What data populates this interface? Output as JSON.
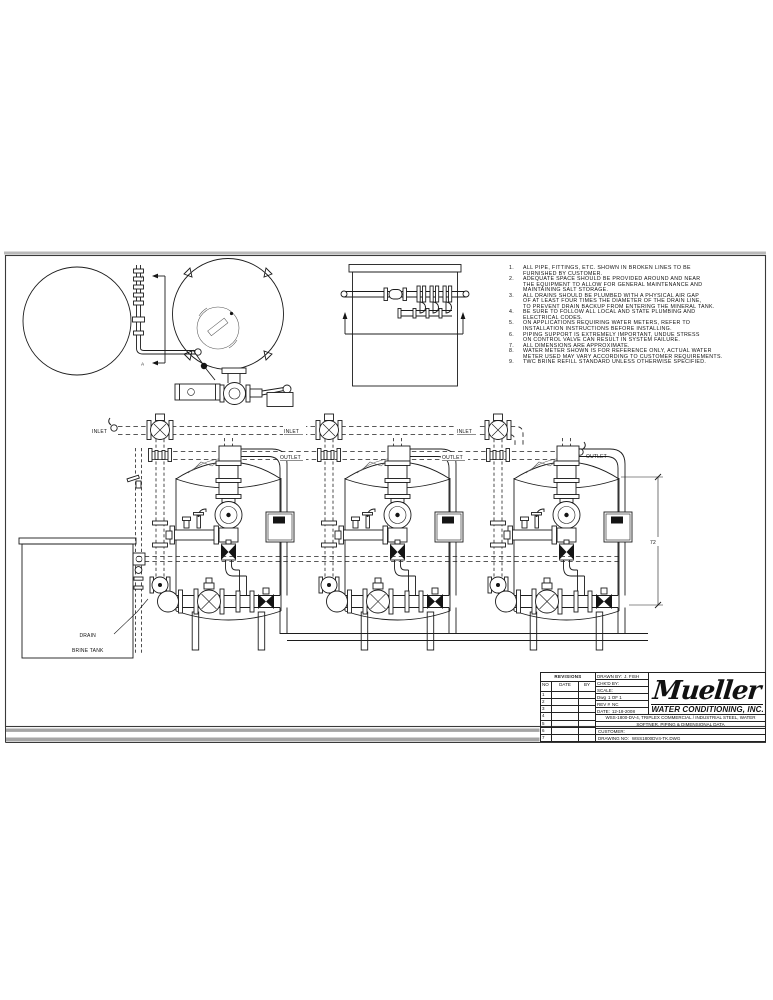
{
  "labels": {
    "inlet": "INLET",
    "outlet": "OUTLET",
    "drain": "DRAIN",
    "brine_tank": "BRINE TANK",
    "height_dim": "72",
    "section_marker": "A"
  },
  "notes": {
    "items": [
      {
        "num": "1.",
        "lines": [
          "ALL PIPE, FITTINGS, ETC. SHOWN IN BROKEN LINES TO BE",
          "FURNISHED BY CUSTOMER."
        ]
      },
      {
        "num": "2.",
        "lines": [
          "ADEQUATE SPACE SHOULD BE PROVIDED AROUND AND NEAR",
          "THE EQUIPMENT TO ALLOW FOR GENERAL MAINTENANCE AND",
          "MAINTAINING SALT STORAGE."
        ]
      },
      {
        "num": "3.",
        "lines": [
          "ALL DRAINS SHOULD BE PLUMBED WITH A PHYSICAL AIR GAP",
          "OF AT LEAST FOUR TIMES THE DIAMETER OF THE DRAIN LINE,",
          "TO PREVENT DRAIN BACKUP FROM ENTERING THE MINERAL TANK."
        ]
      },
      {
        "num": "4.",
        "lines": [
          "BE SURE TO FOLLOW ALL LOCAL AND STATE PLUMBING AND",
          "ELECTRICAL CODES."
        ]
      },
      {
        "num": "5.",
        "lines": [
          "ON APPLICATIONS REQUIRING WATER METERS, REFER TO",
          "INSTALLATION INSTRUCTIONS BEFORE INSTALLING."
        ]
      },
      {
        "num": "6.",
        "lines": [
          "PIPING SUPPORT IS EXTREMELY IMPORTANT, UNDUE STRESS",
          "ON CONTROL VALVE CAN RESULT IN SYSTEM FAILURE."
        ]
      },
      {
        "num": "7.",
        "lines": [
          "ALL DIMENSIONS ARE APPROXIMATE."
        ]
      },
      {
        "num": "8.",
        "lines": [
          "WATER METER SHOWN IS FOR REFERENCE ONLY, ACTUAL WATER",
          "METER USED MAY VARY ACCORDING TO CUSTOMER REQUIREMENTS."
        ]
      },
      {
        "num": "9.",
        "lines": [
          "TWC BRINE REFILL STANDARD UNLESS OTHERWISE SPECIFIED."
        ]
      }
    ]
  },
  "title_block": {
    "revisions": {
      "title": "REVISIONS",
      "col_no": "NO",
      "col_date": "DATE",
      "col_by": "BY",
      "rows": [
        "1",
        "2",
        "3",
        "4",
        "5",
        "6",
        "7"
      ]
    },
    "drawn_by_label": "DRAWN BY:",
    "drawn_by": "J. FISH",
    "chkd_by_label": "CHK'D BY:",
    "scale_label": "SCALE:",
    "dwg_label": "Dwg",
    "dwg_value": "1 OF 1",
    "rev_label": "REV #",
    "rev_value": "NC",
    "date_label": "DATE:",
    "date_value": "12-18-2008",
    "company_name": "Mueller",
    "company_subtitle": "WATER CONDITIONING, INC.",
    "desc_line1": "WSS-1800-DV-4, TRIPLEX COMMERCIAL / INDUSTRIAL STEEL, WATER",
    "desc_line2": "SOFTNER, PIPING & DIMENSIONAL DATA",
    "customer_label": "CUSTOMER:",
    "drawing_no_label": "DRAWING NO:",
    "drawing_no": "WSS1800DV4-TK.DWG"
  }
}
